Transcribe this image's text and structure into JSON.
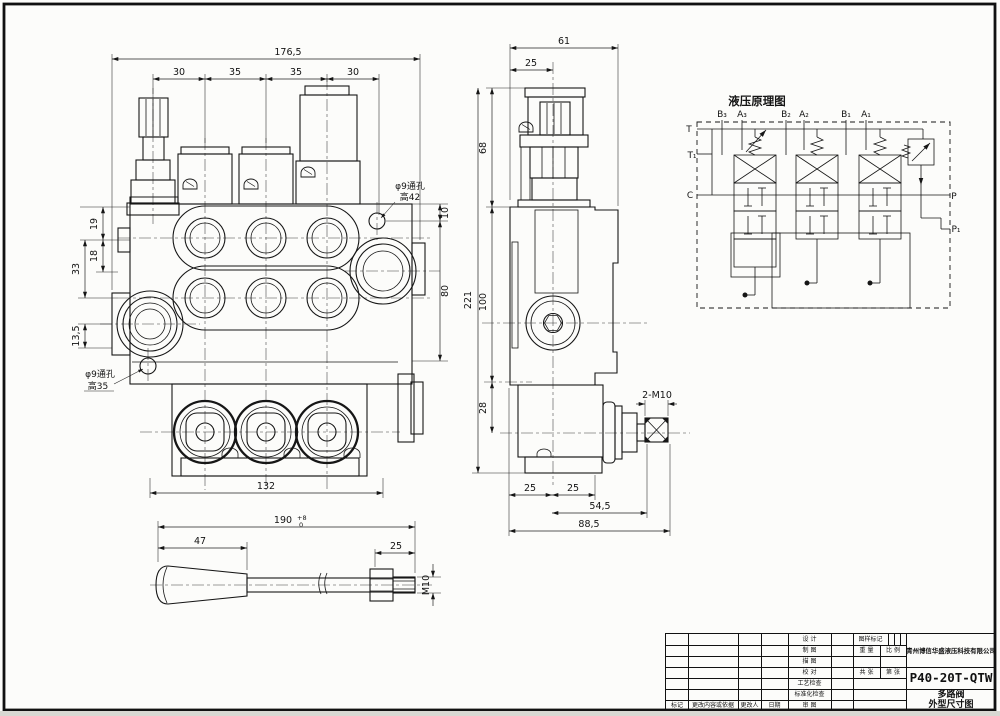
{
  "schematic": {
    "title": "液压原理图",
    "ports": {
      "t": "T",
      "t1": "T₁",
      "c": "C",
      "p": "P",
      "p1": "P₁"
    },
    "work_ports": [
      "B₃",
      "A₃",
      "B₂",
      "A₂",
      "B₁",
      "A₁"
    ]
  },
  "front_view": {
    "dim_overall_width": "176,5",
    "dim_spacings": [
      "30",
      "35",
      "35",
      "30"
    ],
    "dim_left_19": "19",
    "dim_left_18": "18",
    "dim_left_33": "33",
    "dim_left_135": "13,5",
    "dim_right_10": "10",
    "dim_right_80": "80",
    "dim_bottom_132": "132",
    "note_hole_top_1": "φ9通孔",
    "note_hole_top_2": "高42",
    "note_hole_bottom_1": "φ9通孔",
    "note_hole_bottom_2": "高35"
  },
  "side_view": {
    "dim_width_61": "61",
    "dim_width_25": "25",
    "dim_height_68": "68",
    "dim_height_221": "221",
    "dim_height_100": "100",
    "dim_height_28": "28",
    "dim_bottom_25a": "25",
    "dim_bottom_25b": "25",
    "dim_bottom_545": "54,5",
    "dim_bottom_885": "88,5",
    "note_thread": "2-M10"
  },
  "handle_view": {
    "dim_length": "190",
    "dim_length_tol_upper": "+8",
    "dim_length_tol_lower": "0",
    "dim_grip_47": "47",
    "dim_thread_25": "25",
    "note_thread": "M10"
  },
  "title_block": {
    "company": "青州博信华盛液压科技有限公司",
    "model": "P40-20T-QTW",
    "product_name": "多路阀",
    "drawing_name": "外型尺寸图",
    "sign_rows": [
      "设 计",
      "制 图",
      "描 图",
      "校 对",
      "工艺检查",
      "标准化检查"
    ],
    "bottom_row": {
      "mark": "标记",
      "content": "更改内容或依据",
      "changer": "更改人",
      "date": "日期",
      "review": "审 图"
    },
    "mark_header": "图样标记",
    "weight_label": "重 量",
    "scale_label": "比 例",
    "total_sheets_label": "共 张",
    "sheet_no_label": "第 张"
  }
}
